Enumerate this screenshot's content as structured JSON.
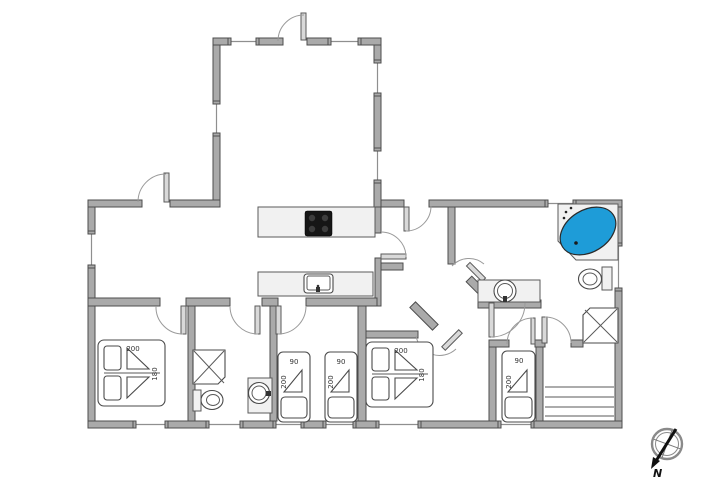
{
  "compass": {
    "label": "N"
  },
  "colors": {
    "wall_fill": "#aaaaaa",
    "wall_stroke": "#4d4d4d",
    "fixture_fill": "#f1f1f1",
    "tub_water": "#1e9cd8",
    "cooktop": "#161616"
  },
  "beds": {
    "double_1": {
      "length": "200",
      "width": "180"
    },
    "double_2": {
      "length": "200",
      "width": "180"
    },
    "single_1": {
      "width": "90",
      "length": "200"
    },
    "single_2": {
      "width": "90",
      "length": "200"
    },
    "single_3": {
      "width": "90",
      "length": "200"
    }
  }
}
